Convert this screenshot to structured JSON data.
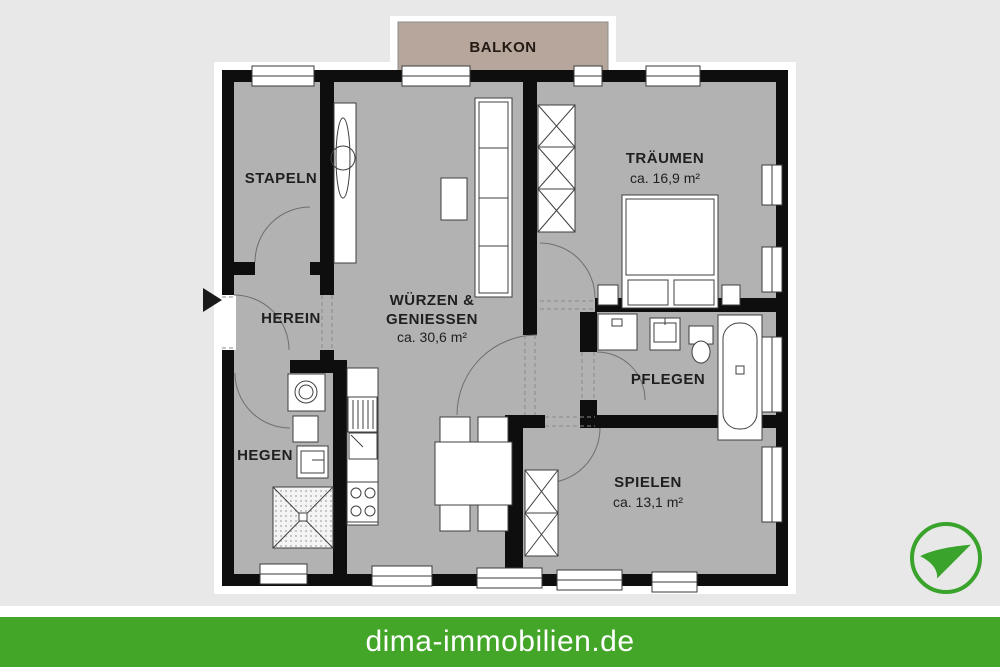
{
  "page": {
    "background": "#e8e8e8"
  },
  "plan": {
    "balcony_label": "BALKON",
    "rooms": [
      {
        "name": "stapeln",
        "label": "STAPELN"
      },
      {
        "name": "herein",
        "label": "HEREIN"
      },
      {
        "name": "wuerzen-geniessen",
        "label_line1": "WÜRZEN &",
        "label_line2": "GENIESSEN",
        "area": "ca. 30,6 m²"
      },
      {
        "name": "traeumen",
        "label": "TRÄUMEN",
        "area": "ca. 16,9 m²"
      },
      {
        "name": "pflegen",
        "label": "PFLEGEN"
      },
      {
        "name": "hegen",
        "label": "HEGEN"
      },
      {
        "name": "spielen",
        "label": "SPIELEN",
        "area": "ca. 13,1 m²"
      }
    ],
    "colors": {
      "floor": "#b2b2b2",
      "wall": "#0e0e0e",
      "balcony": "#b7a69c"
    }
  },
  "footer": {
    "text": "dima-immobilien.de",
    "bar_color": "#43a629"
  },
  "logo": {
    "icon": "paper-plane-icon",
    "color": "#3aa32b"
  }
}
